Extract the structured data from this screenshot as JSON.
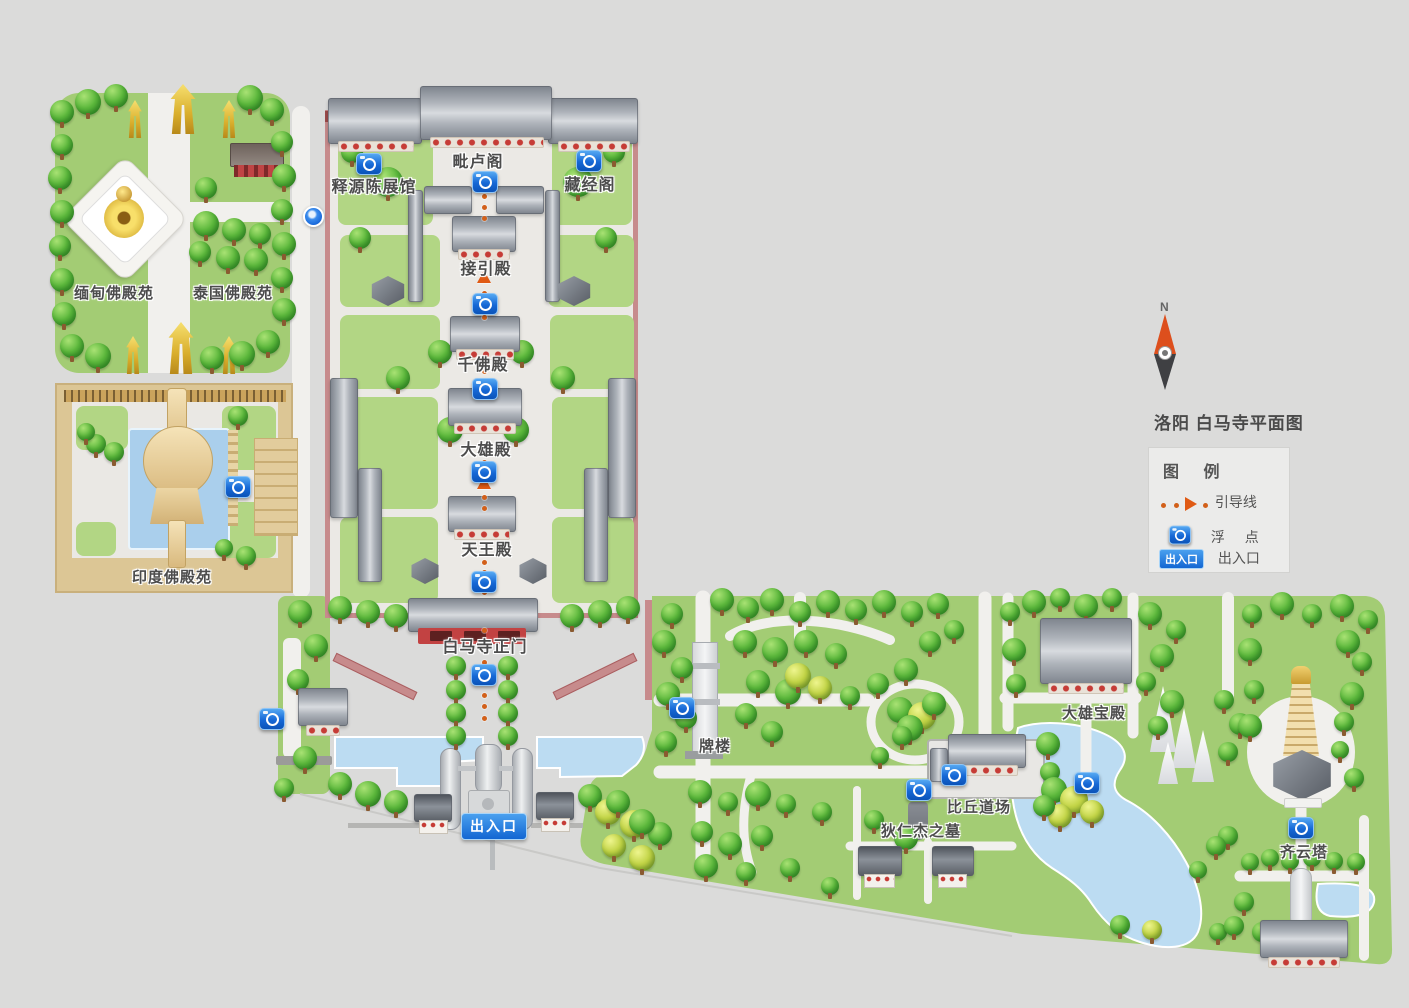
{
  "title": "洛阳 白马寺平面图",
  "compass": {
    "north": "N"
  },
  "legend": {
    "header": "图  例",
    "guide_line_label": "引导线",
    "float_point_label": "浮  点",
    "entrance_row_label": "出入口",
    "entrance_badge_text": "出入口"
  },
  "map": {
    "entrance_badge_text": "出入口"
  },
  "places": {
    "shiyuan": {
      "label": "释源陈展馆"
    },
    "pilu": {
      "label": "毗卢阁"
    },
    "cangjing": {
      "label": "藏经阁"
    },
    "jieyin": {
      "label": "接引殿"
    },
    "qianfo": {
      "label": "千佛殿"
    },
    "daxiong": {
      "label": "大雄殿"
    },
    "tianwang": {
      "label": "天王殿"
    },
    "zhengmen": {
      "label": "白马寺正门"
    },
    "myanmar": {
      "label": "缅甸佛殿苑"
    },
    "thailand": {
      "label": "泰国佛殿苑"
    },
    "india": {
      "label": "印度佛殿苑"
    },
    "pailou": {
      "label": "牌楼"
    },
    "biqiu": {
      "label": "比丘道场"
    },
    "direnjie": {
      "label": "狄仁杰之墓"
    },
    "daxiongbao": {
      "label": "大雄宝殿"
    },
    "qiyunta": {
      "label": "齐云塔"
    }
  },
  "colors": {
    "background": "#dbdbda",
    "grass": "#a3cc74",
    "water": "#bcdcf2",
    "path": "#f1f0ed",
    "wall_pink": "#c78b8c",
    "accent_blue": "#1668d6",
    "guide_orange": "#e05a14"
  }
}
